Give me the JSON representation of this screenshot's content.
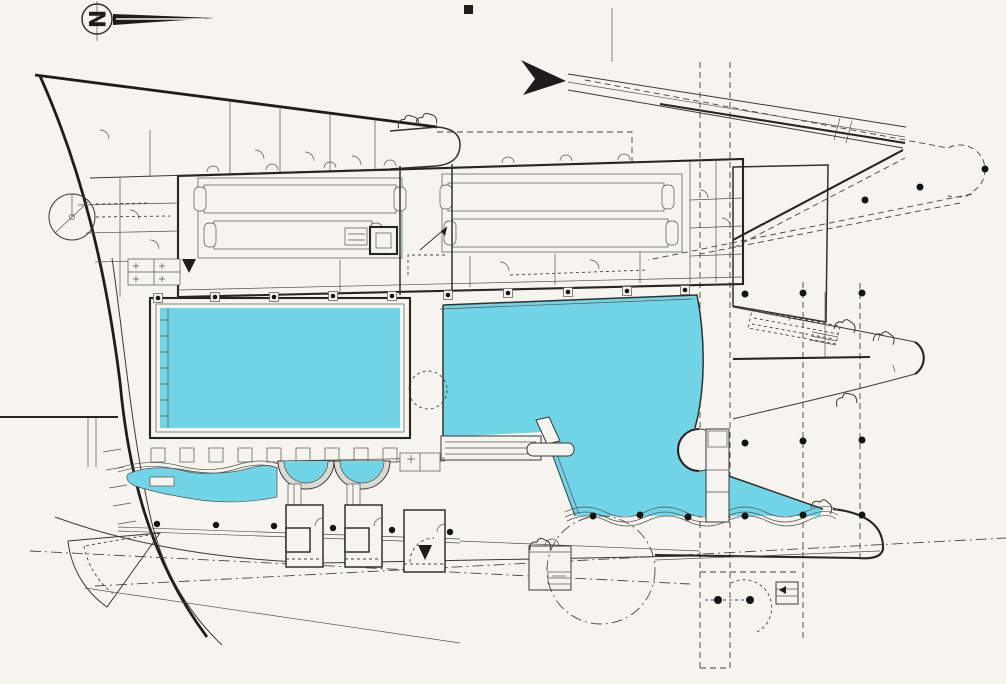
{
  "drawing": {
    "kind": "architectural-site-plan",
    "subject": "open-air swimming pool complex plan with two large pools, paddling pools, changing-cabin building, pavilions and landscaped paths",
    "north": {
      "letter": "N"
    },
    "palette": {
      "paper": "#f5f4ef",
      "ink": "#1e1d1b",
      "line": "#3a3935",
      "water": "#71d4e7",
      "pool_ring": "#dbdad3",
      "tree_dot": "#141414"
    },
    "features": {
      "north_arrow": "compass with letter and long east-pointing needle",
      "entry_ramp": "black arrow and long diagonal ramp band to upper right",
      "main_building": "long changing-room wing with four rows of cubicles",
      "entrance_block": "entry rooms with circular turnstile",
      "pool_main": "rectangular swimming pool",
      "pool_free_form": "large irregular pool with round island and pier",
      "paddling_pools": "wavy-edged children's pool and two semicircular basins",
      "pavilions": "three small service pavilions",
      "lawn": "trapezoid lawn panel, east side",
      "leaf_terrace": "pointed leaf-shaped terrace, east tip",
      "tree_rows": "dashed paths with tree dots",
      "boundary": "curved west site boundary and dash-dot property lines"
    }
  }
}
